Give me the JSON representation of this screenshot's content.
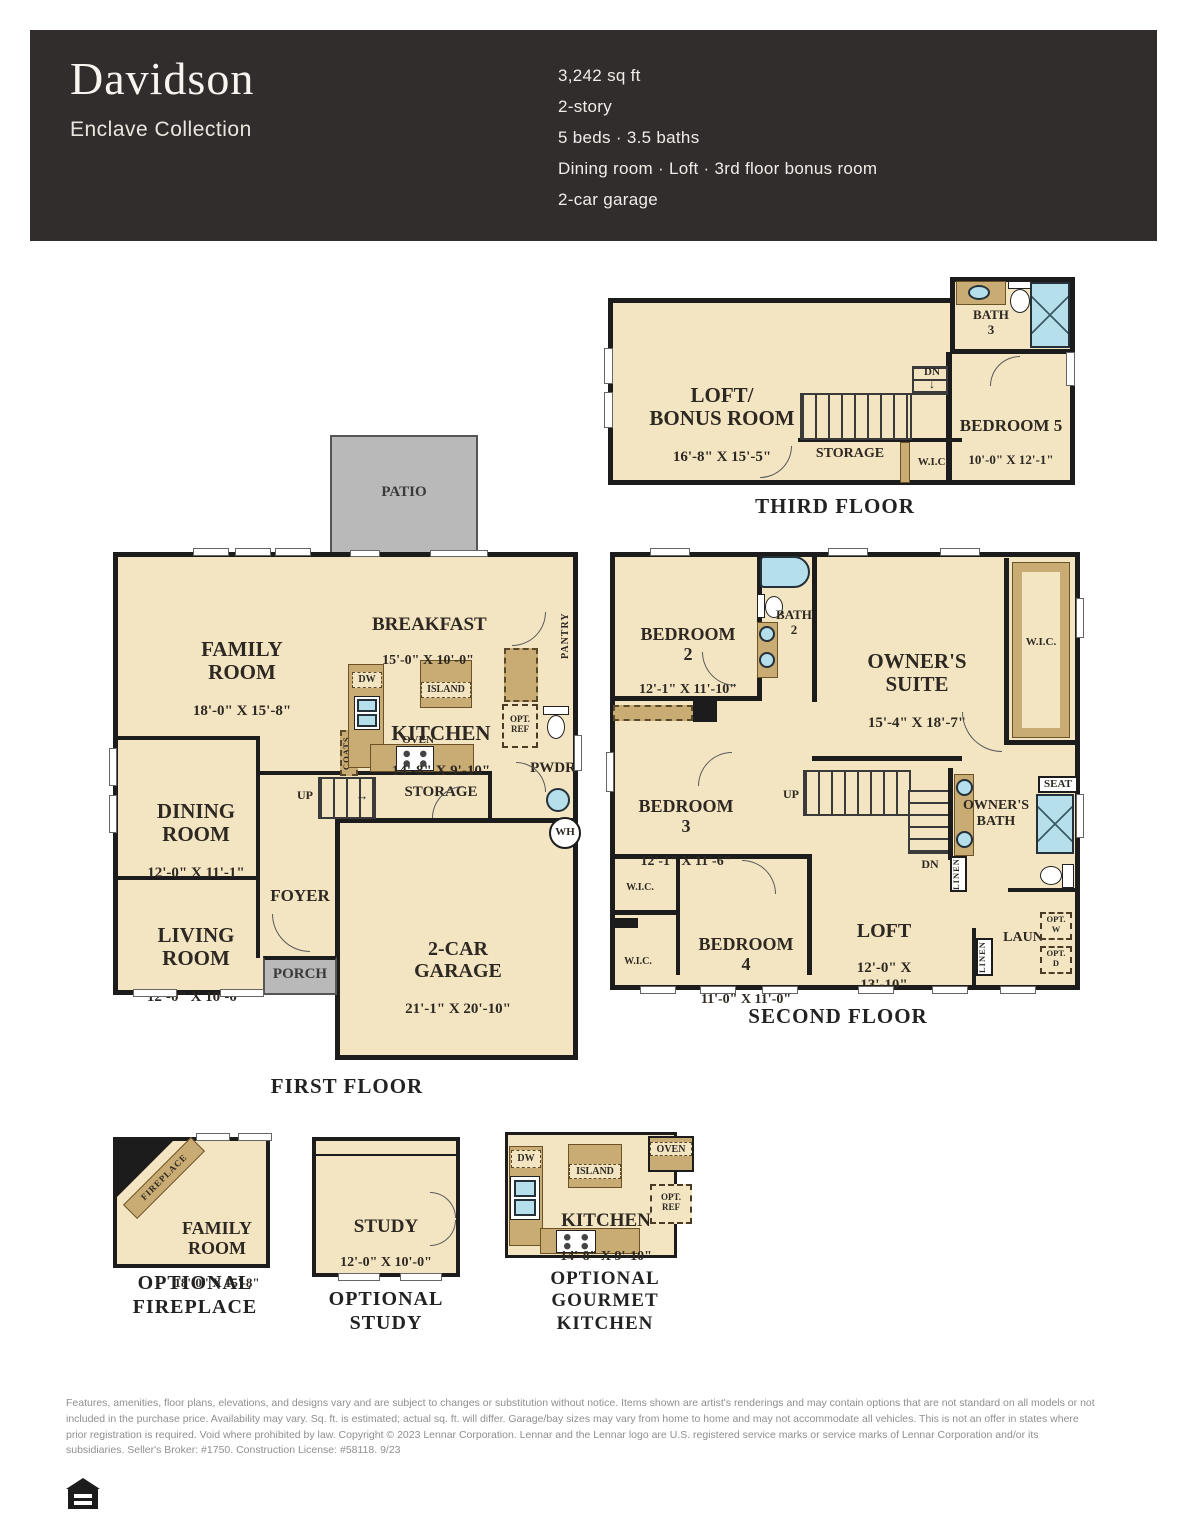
{
  "header": {
    "title": "Davidson",
    "collection": "Enclave Collection",
    "specs": [
      "3,242 sq ft",
      "2-story",
      "5 beds · 3.5 baths",
      "Dining room · Loft · 3rd floor bonus room",
      "2-car garage"
    ]
  },
  "icons": {
    "down_arrow": "↓",
    "right_arrow": "→"
  },
  "third": {
    "caption": "THIRD FLOOR",
    "loft": {
      "name": "LOFT/\nBONUS ROOM",
      "dims": "16'-8\" X 15'-5\""
    },
    "bath": {
      "name": "BATH\n3"
    },
    "bed5": {
      "name": "BEDROOM 5",
      "dims": "10'-0\" X 12'-1\""
    },
    "storage": "STORAGE",
    "wic": "W.I.C.",
    "dn": "DN"
  },
  "first": {
    "caption": "FIRST FLOOR",
    "patio": "PATIO",
    "family": {
      "name": "FAMILY\nROOM",
      "dims": "18'-0\" X 15'-8\""
    },
    "breakfast": {
      "name": "BREAKFAST",
      "dims": "15'-0\" X 10'-0\""
    },
    "kitchen": {
      "name": "KITCHEN",
      "dims": "14'-8\" X 9'-10\""
    },
    "island": "ISLAND",
    "dw": "DW",
    "oven": "OVEN",
    "opt_ref": "OPT.\nREF",
    "pantry": "PANTRY",
    "coats": "COATS",
    "up": "UP",
    "storage": "STORAGE",
    "pwdr": "PWDR",
    "wh": "WH",
    "dining": {
      "name": "DINING\nROOM",
      "dims": "12'-0\" X 11'-1\""
    },
    "living": {
      "name": "LIVING\nROOM",
      "dims": "12'-0\" X 10'-0\""
    },
    "foyer": "FOYER",
    "porch": "PORCH",
    "garage": {
      "name": "2-CAR GARAGE",
      "dims": "21'-1\" X 20'-10\""
    }
  },
  "second": {
    "caption": "SECOND FLOOR",
    "bed2": {
      "name": "BEDROOM 2",
      "dims": "12'-1\" X 11'-10\""
    },
    "bath2": {
      "name": "BATH\n2"
    },
    "suite": {
      "name": "OWNER'S\nSUITE",
      "dims": "15'-4\" X 18'-7\""
    },
    "wic_r": "W.I.C.",
    "bed3": {
      "name": "BEDROOM 3",
      "dims": "12'-1\" X 11'-6\""
    },
    "up": "UP",
    "dn": "DN",
    "owners_bath": "OWNER'S\nBATH",
    "seat": "SEAT",
    "linen_a": "LINEN",
    "linen_b": "LINEN",
    "bed4": {
      "name": "BEDROOM 4",
      "dims": "11'-0\" X 11'-0\""
    },
    "wic_a": "W.I.C.",
    "wic_b": "W.I.C.",
    "loft": {
      "name": "LOFT",
      "dims": "12'-0\" X 13'-10\""
    },
    "laun": "LAUN",
    "opt_w": "OPT.\nW",
    "opt_d": "OPT.\nD"
  },
  "options": {
    "fireplace": {
      "caption": "OPTIONAL\nFIREPLACE",
      "room": "FAMILY\nROOM",
      "dims": "18'-0\" X 15'-8\"",
      "label": "FIREPLACE"
    },
    "study": {
      "caption": "OPTIONAL STUDY",
      "room": "STUDY",
      "dims": "12'-0\" X 10'-0\""
    },
    "gourmet": {
      "caption": "OPTIONAL\nGOURMET KITCHEN",
      "room": "KITCHEN",
      "dims": "14'-8\" X 9'-10\"",
      "island": "ISLAND",
      "dw": "DW",
      "oven": "OVEN",
      "opt_ref": "OPT.\nREF"
    }
  },
  "footer": {
    "disclaimer": "Features, amenities, floor plans, elevations, and designs vary and are subject to changes or substitution without notice. Items shown are artist's renderings and may contain options that are not standard on all models or not included in the purchase price. Availability may vary. Sq. ft. is estimated; actual sq. ft. will differ. Garage/bay sizes may vary from home to home and may not accommodate all vehicles. This is not an offer in states where prior registration is required. Void where prohibited by law. Copyright © 2023 Lennar Corporation. Lennar and the Lennar logo are U.S. registered service marks or service marks of Lennar Corporation and/or its subsidiaries. Seller's Broker: #1750. Construction License: #58118. 9/23",
    "equal_housing_icon": "equal-housing-opportunity"
  },
  "colors": {
    "header_bg": "#312d2c",
    "room_fill": "#f4e5c2",
    "cabinet_fill": "#c9ab74",
    "fixture_blue": "#b5dfeb",
    "patio_gray": "#b9b9b9",
    "wall_black": "#1c1c1c"
  }
}
